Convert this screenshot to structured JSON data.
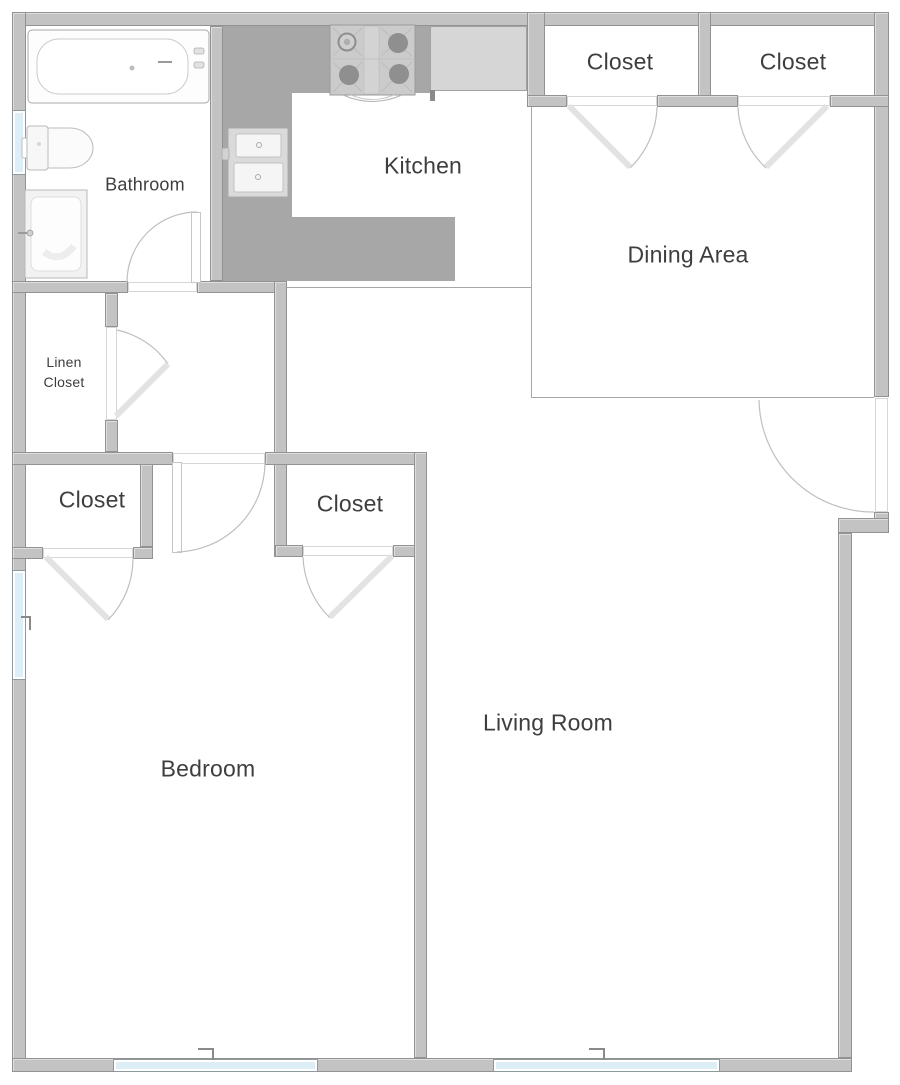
{
  "rooms": {
    "bathroom": {
      "label": "Bathroom"
    },
    "kitchen": {
      "label": "Kitchen"
    },
    "closet_top_left": {
      "label": "Closet"
    },
    "closet_top_right": {
      "label": "Closet"
    },
    "dining_area": {
      "label": "Dining Area"
    },
    "linen_closet": {
      "line1": "Linen",
      "line2": "Closet"
    },
    "closet_hall": {
      "label": "Closet"
    },
    "closet_bedroom": {
      "label": "Closet"
    },
    "bedroom": {
      "label": "Bedroom"
    },
    "living_room": {
      "label": "Living Room"
    }
  },
  "colors": {
    "wall": "#c3c3c3",
    "wall_border": "#929292",
    "counter_dark": "#a7a7a7",
    "counter_light": "#d6d6d6",
    "window_glass": "#ddeef6",
    "floor": "#ffffff",
    "label_text": "#3e3e3e",
    "door_arc": "#bfbfbf",
    "door_leaf": "#e3e3e3"
  }
}
